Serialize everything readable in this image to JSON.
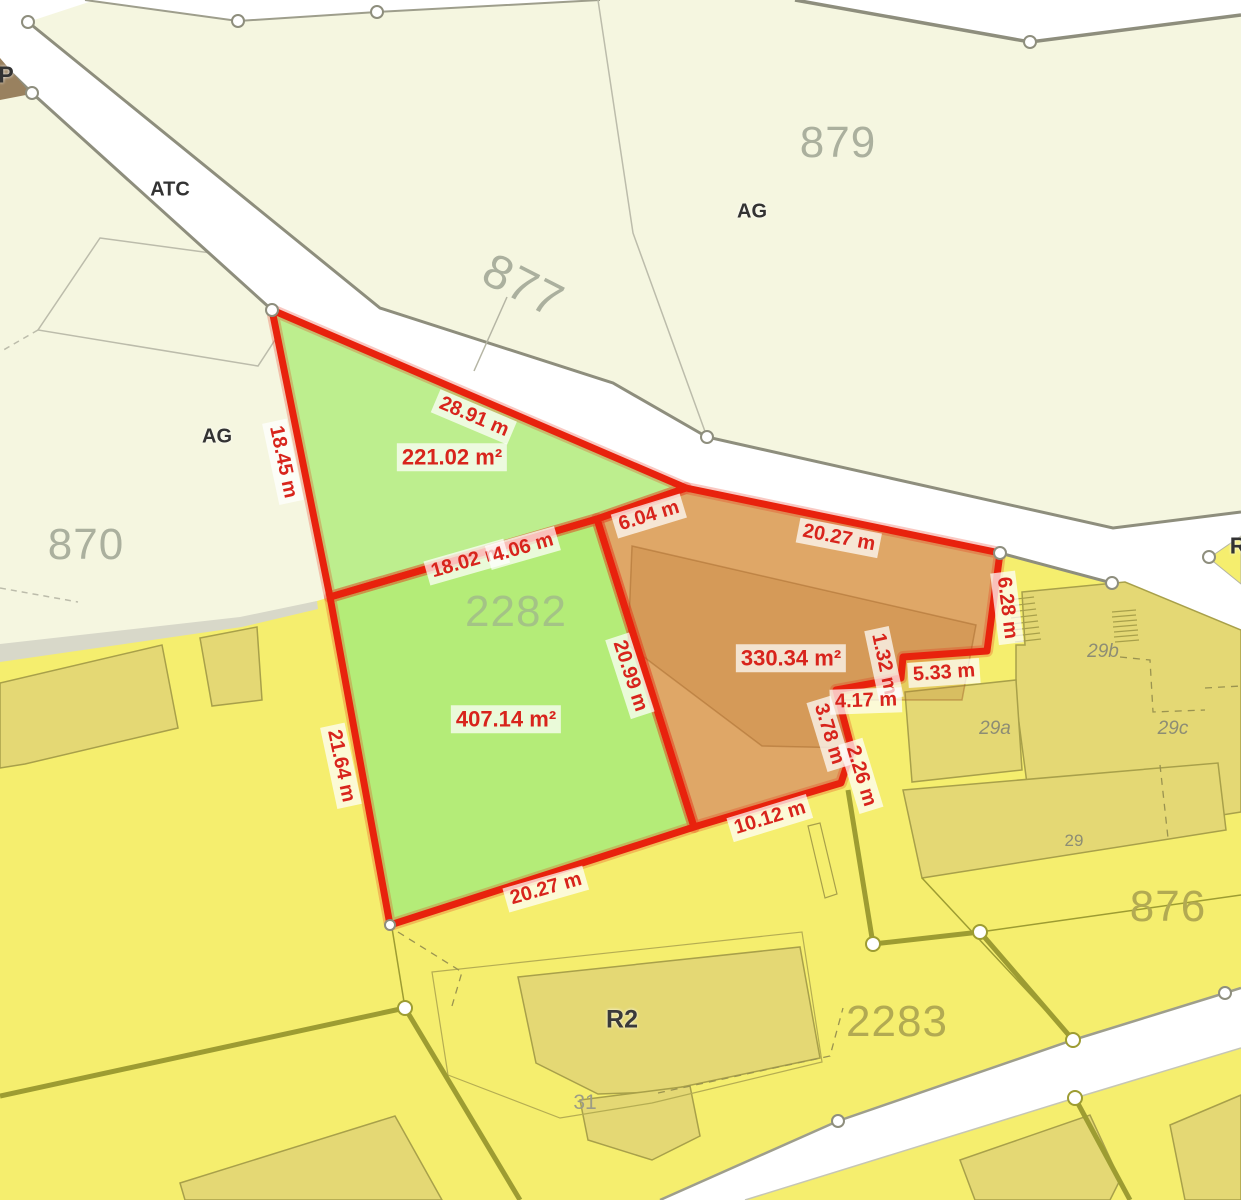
{
  "map_type": "cadastral-parcel-measurement-view",
  "parcels": {
    "p877": "877",
    "p879": "879",
    "p870": "870",
    "p876": "876",
    "p2282": "2282",
    "p2283": "2283"
  },
  "zones": {
    "p_corner": "P",
    "atc": "ATC",
    "ag_upper": "AG",
    "ag_left": "AG",
    "r_edge": "R",
    "r2": "R2"
  },
  "buildings": {
    "n29": "29",
    "n29a": "29a",
    "n29b": "29b",
    "n29c": "29c",
    "n31": "31"
  },
  "measurements": {
    "triangle": {
      "area": "221.02 m²",
      "edge_top": "28.91 m",
      "edge_left": "18.45 m",
      "edge_bottom_a": "18.02 m",
      "edge_bottom_b": "4.06 m"
    },
    "main_green": {
      "area": "407.14 m²",
      "edge_left": "21.64 m",
      "edge_bottom": "20.27 m",
      "edge_right": "20.99 m"
    },
    "orange": {
      "area": "330.34 m²",
      "edge_link": "6.04 m",
      "edge_top": "20.27 m",
      "edge_right": "6.28 m",
      "edge_step_a": "5.33 m",
      "edge_step_b": "1.32 m",
      "edge_step_c": "4.17 m",
      "edge_step_d": "3.78 m",
      "edge_step_e": "2.26 m",
      "edge_bottom": "10.12 m"
    }
  },
  "colors": {
    "cream_area": "#f5f6e0",
    "yellow_area": "#f5ee6e",
    "building_khaki": "#e4d874",
    "building_outline": "#a8a04a",
    "green_parcel_light": "#bdee8e",
    "green_parcel": "#b4ec78",
    "orange_parcel": "#dfa767",
    "red_boundary": "#e8220d",
    "red_text": "#d8241c",
    "road_white": "#ffffff",
    "road_edge_gray": "#8e8e7d",
    "olive_boundary": "#9d9c32"
  }
}
